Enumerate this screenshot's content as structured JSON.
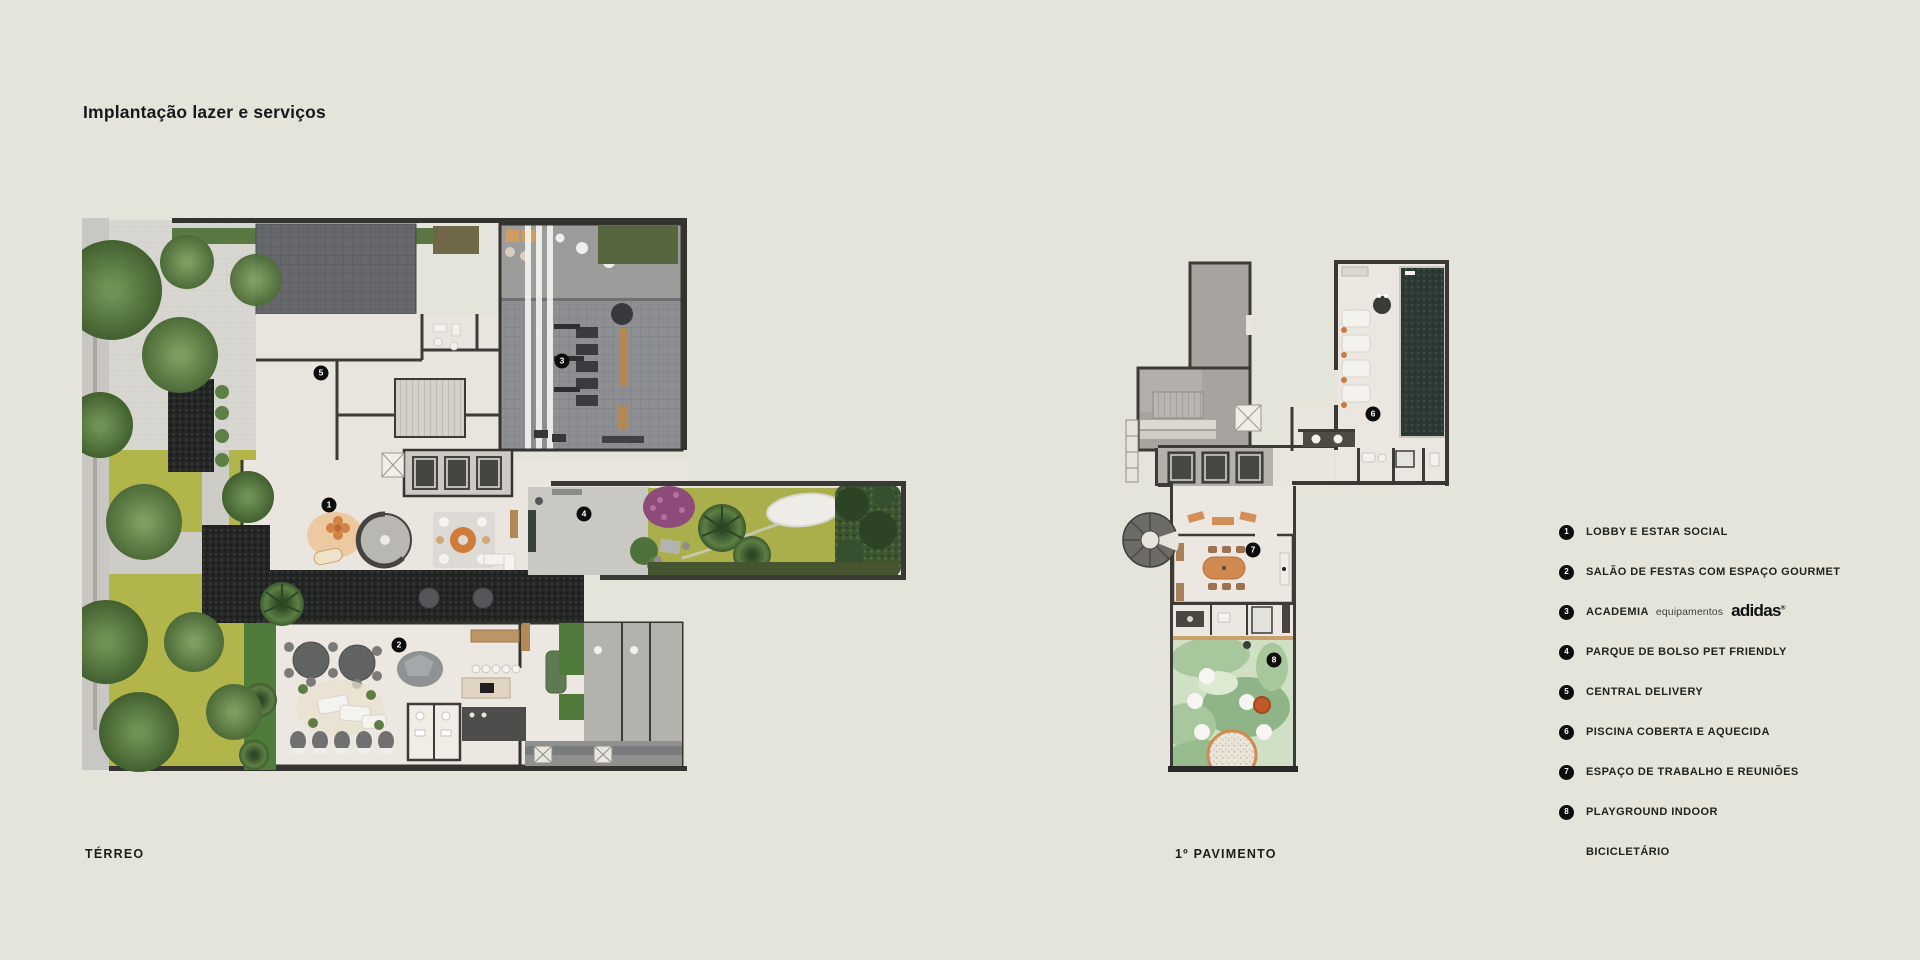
{
  "header": {
    "title": "Implantação lazer e serviços"
  },
  "plans": {
    "terreo": {
      "caption": "TÉRREO"
    },
    "pavimento": {
      "caption": "1º PAVIMENTO"
    }
  },
  "markers": [
    "1",
    "2",
    "3",
    "4",
    "5",
    "6",
    "7",
    "8"
  ],
  "legend": {
    "items": [
      {
        "num": "1",
        "label": "LOBBY E ESTAR SOCIAL"
      },
      {
        "num": "2",
        "label": "SALÃO DE FESTAS COM ESPAÇO GOURMET"
      },
      {
        "num": "3",
        "label": "ACADEMIA",
        "sub": "equipamentos",
        "brand": "adidas",
        "brand_mark": "®"
      },
      {
        "num": "4",
        "label": "PARQUE DE BOLSO PET FRIENDLY"
      },
      {
        "num": "5",
        "label": "CENTRAL DELIVERY"
      },
      {
        "num": "6",
        "label": "PISCINA COBERTA E AQUECIDA"
      },
      {
        "num": "7",
        "label": "ESPAÇO DE TRABALHO E REUNIÕES"
      },
      {
        "num": "8",
        "label": "PLAYGROUND INDOOR"
      },
      {
        "num": "",
        "label": "BICICLETÁRIO"
      }
    ]
  },
  "colors": {
    "background": "#e4e4db",
    "marker": "#0d0d0d",
    "wall": "#3a3936",
    "floor": "#ebe7e0",
    "lawn": "#b2b54a",
    "pool_water": "#2d3a33",
    "playground": "#cfe0c5",
    "gym_floor": "#8e8f92"
  }
}
